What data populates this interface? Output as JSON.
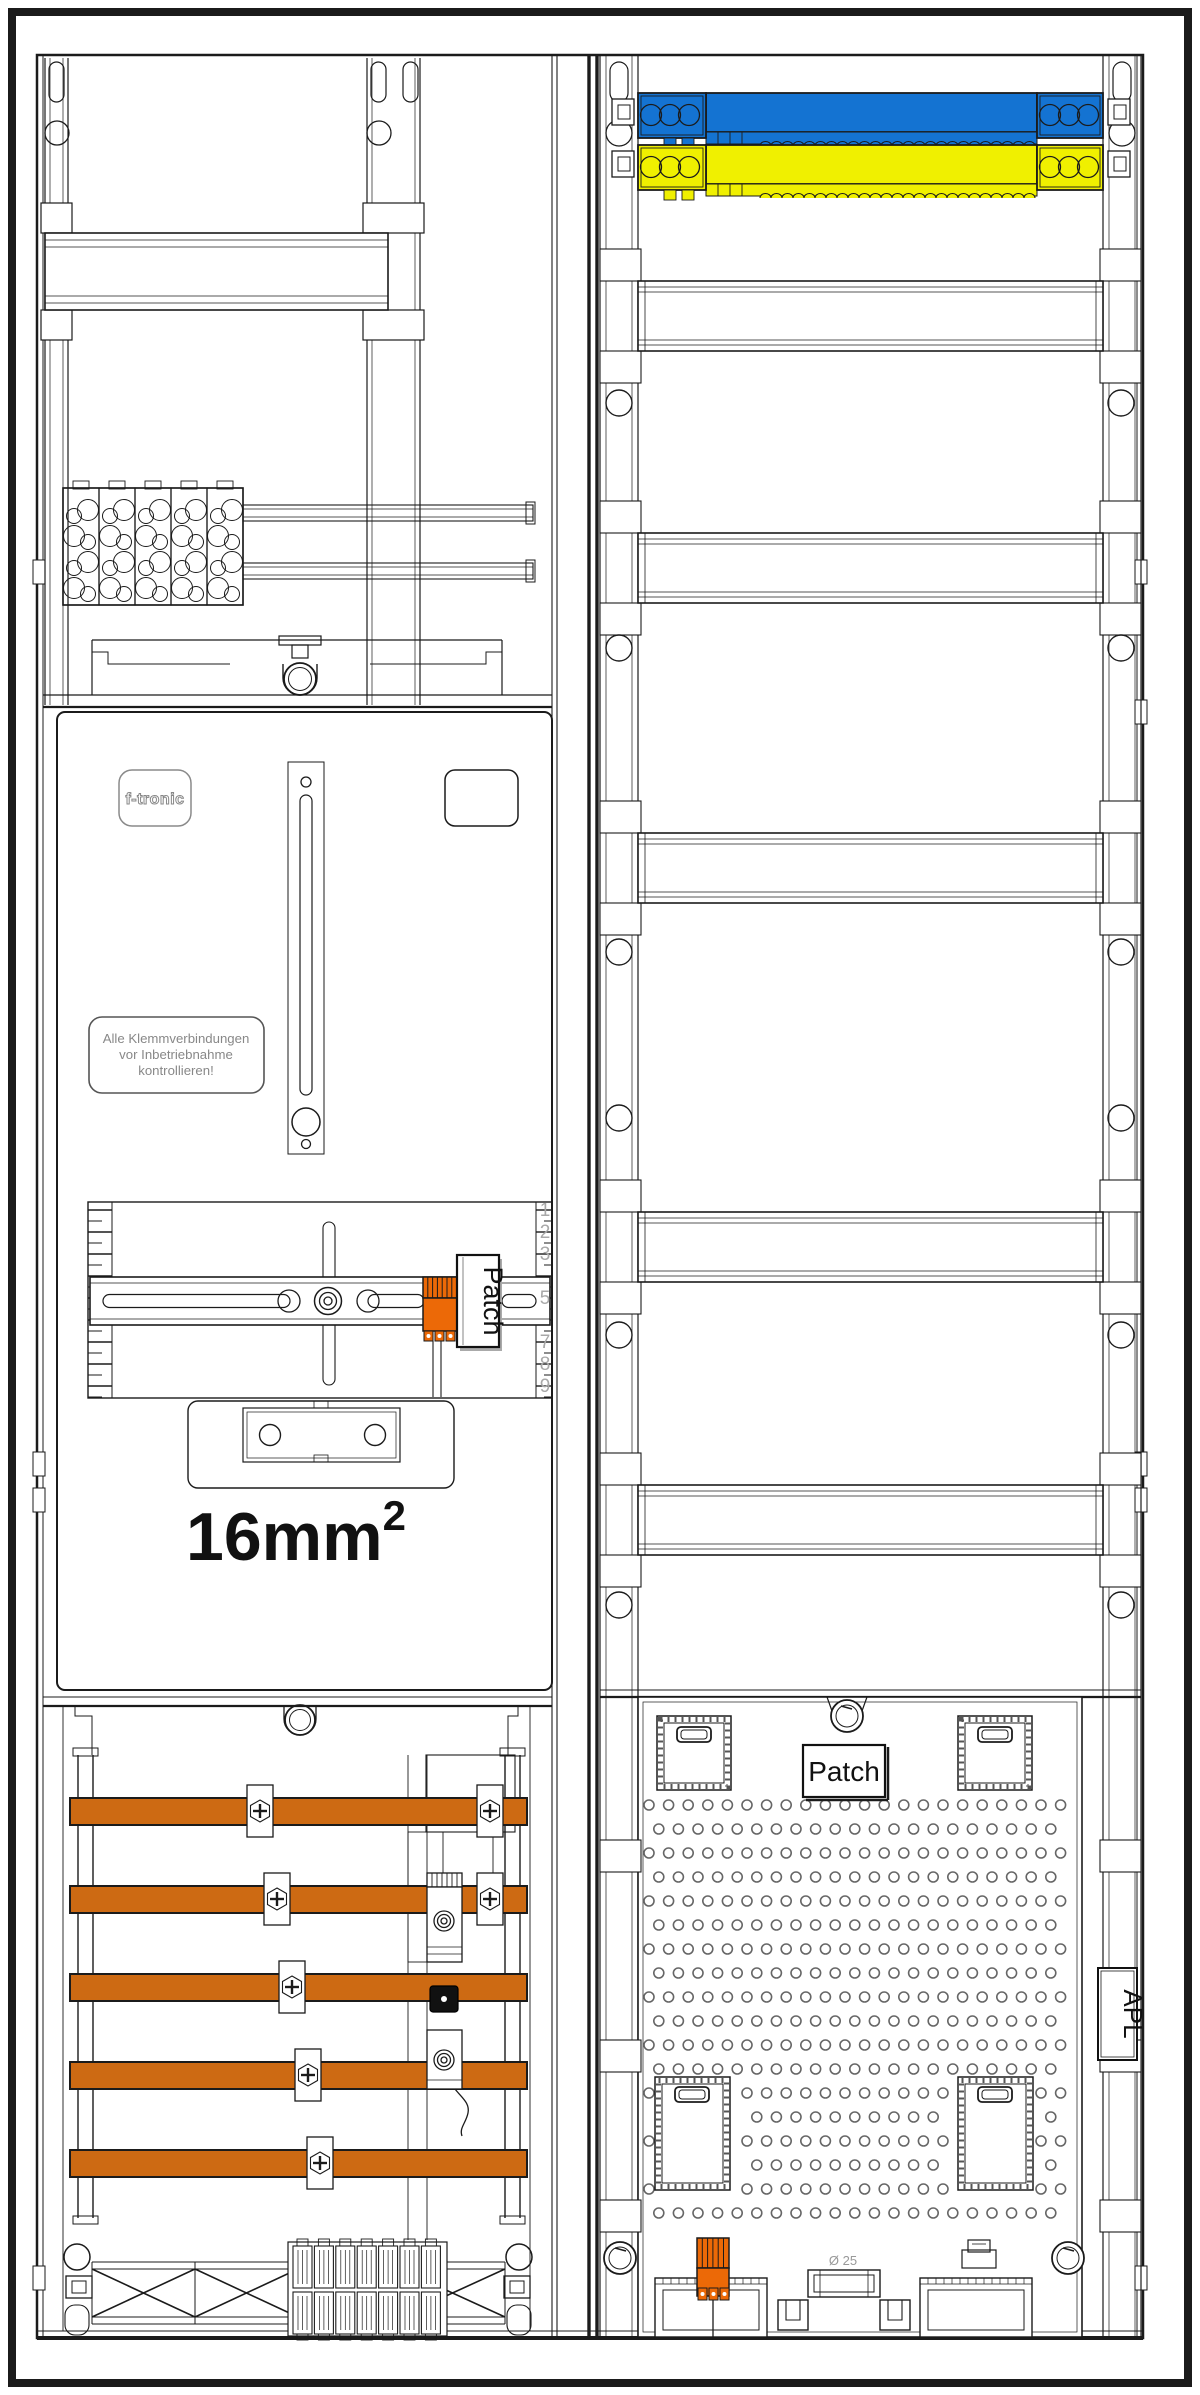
{
  "drawing": {
    "brand_label": "f-tronic",
    "warning_note": {
      "lines": [
        "Alle Klemmverbindungen",
        "vor Inbetriebnahme",
        "kontrollieren!"
      ]
    },
    "cross_section": {
      "value": "16mm",
      "exponent": "2"
    },
    "labels": {
      "patch_left": "Patch",
      "patch_right": "Patch",
      "apl": "APL",
      "knockout_diameter": "Ø 25"
    },
    "ruler": {
      "numbers": [
        "1",
        "2",
        "3",
        "4",
        "5",
        "6",
        "7",
        "8",
        "9"
      ],
      "visible_numbers": [
        "1",
        "2",
        "3",
        "5",
        "7",
        "8",
        "9"
      ]
    },
    "colors": {
      "line": "#1b1b1b",
      "busbar_orange": "#CD6A13",
      "device_orange": "#EC6907",
      "busbar_blue": "#1473D2",
      "busbar_yellow": "#F0F000",
      "outline_gray": "#9a9a9a"
    },
    "counts": {
      "left_busbars": 5,
      "right_din_rails": 5,
      "meter_terminal_segments": 5,
      "bottom_terminal_columns": 7,
      "bottom_terminal_rows": 2,
      "busbar_terminal_holes": 3
    },
    "perforation": {
      "rows": 18,
      "row_spacing": 24,
      "hole_spacing": 19.6,
      "hole_radius": 5
    }
  }
}
